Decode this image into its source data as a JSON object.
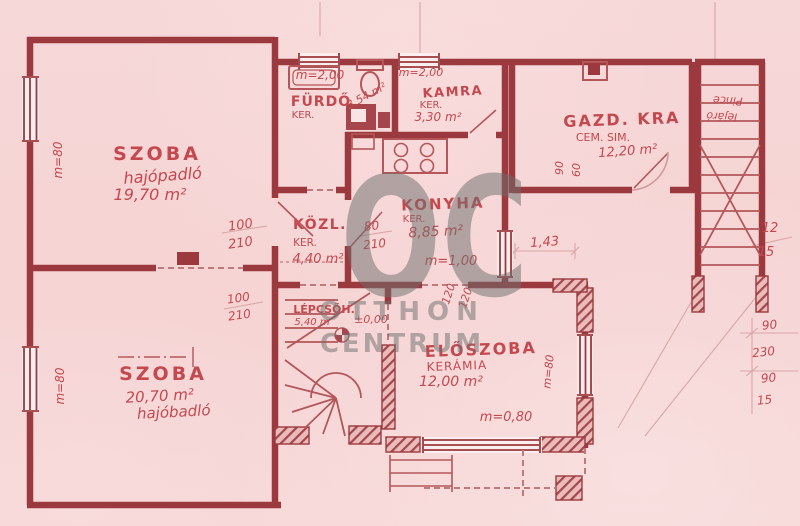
{
  "document": {
    "kind": "scanned floor plan (hand-drawn, Hungarian)"
  },
  "palette": {
    "paper": "#f6d5d5",
    "ink_walls": "#9c393e",
    "ink_medium": "#b4565a",
    "ink_light": "#cf9b9c",
    "text_red": "#c4494f",
    "watermark_gray": "#7a7a7a"
  },
  "watermark": {
    "monogram": "OC",
    "line1": "OTTHON",
    "line2": "CENTRUM"
  },
  "rooms": {
    "szoba1": {
      "name": "SZOBA",
      "floor": "hajópadló",
      "area": "19,70 m²"
    },
    "szoba2": {
      "name": "SZOBA",
      "area": "20,70 m²",
      "floor": "hajóbadló"
    },
    "furdo": {
      "height": "m=2,00",
      "name": "FÜRDŐ",
      "finish": "KER.",
      "area": "3,54 m²"
    },
    "kamra": {
      "height": "m=2,00",
      "name": "KAMRA",
      "finish": "KER.",
      "area": "3,30 m²"
    },
    "gazd": {
      "name": "GAZD. KRA",
      "finish": "CEM. SIM.",
      "area": "12,20 m²",
      "dim_w": "90",
      "dim_h": "60"
    },
    "kozl": {
      "name": "KÖZL.",
      "finish": "KER.",
      "area": "4,40 m²"
    },
    "konyha": {
      "name": "KONYHA",
      "finish": "KER.",
      "area": "8,85 m²"
    },
    "lepcso": {
      "name": "LÉPCSŐH.",
      "length": "5,40 m",
      "level": "±0,00"
    },
    "eloszoba": {
      "name": "ELŐSZOBA",
      "finish": "KERÁMIA",
      "area": "12,00 m²"
    },
    "pince": {
      "line1": "Pince",
      "line2": "lejáró"
    }
  },
  "dimensions": {
    "door_szoba1": {
      "w": "100",
      "h": "210"
    },
    "door_konyha": {
      "w": "80",
      "h": "210"
    },
    "door_szoba2": {
      "w": "100",
      "h": "210"
    },
    "dim_143": "1,43",
    "parapet_konyha": "m=1,00",
    "parapet_bottom": "m=0,80",
    "parapet_left_top": "m=80",
    "parapet_left_bottom": "m=80",
    "parapet_eloszoba": "m=80",
    "v120_a": "120",
    "v120_b": "120",
    "right_fraction": {
      "top": "12",
      "bottom": "15"
    },
    "right_chain": [
      "90",
      "230",
      "90",
      "15"
    ]
  }
}
